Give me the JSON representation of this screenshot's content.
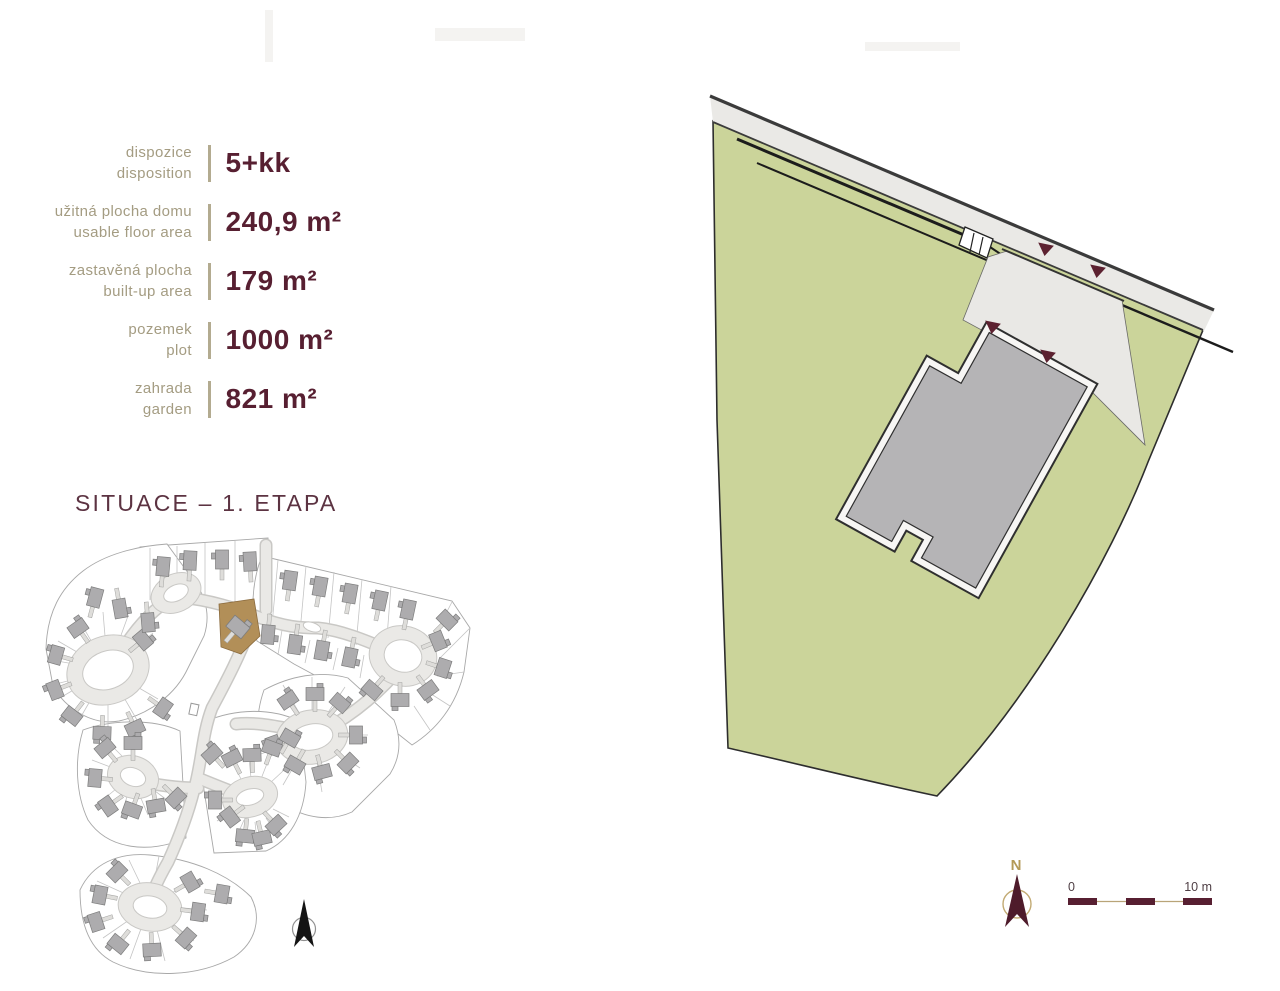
{
  "specs": {
    "rows": [
      {
        "label_cs": "dispozice",
        "label_en": "disposition",
        "value": "5+kk"
      },
      {
        "label_cs": "užitná plocha domu",
        "label_en": "usable floor area",
        "value": "240,9 m²"
      },
      {
        "label_cs": "zastavěná plocha",
        "label_en": "built-up area",
        "value": "179 m²"
      },
      {
        "label_cs": "pozemek",
        "label_en": "plot",
        "value": "1000 m²"
      },
      {
        "label_cs": "zahrada",
        "label_en": "garden",
        "value": "821 m²"
      }
    ]
  },
  "site_plan": {
    "title": "SITUACE – 1. ETAPA",
    "highlight_color": "#b28f58"
  },
  "plot_plan": {
    "north_label": "N",
    "scale_start_label": "0",
    "scale_end_label": "10 m",
    "land_color": "#cbd49a",
    "house_color": "#b5b4b6",
    "marker_color": "#5c2130"
  },
  "colors": {
    "value_maroon": "#571f31",
    "label_tan": "#a49c82",
    "accent_gold": "#b49a58",
    "title_maroon": "#5c3342"
  }
}
